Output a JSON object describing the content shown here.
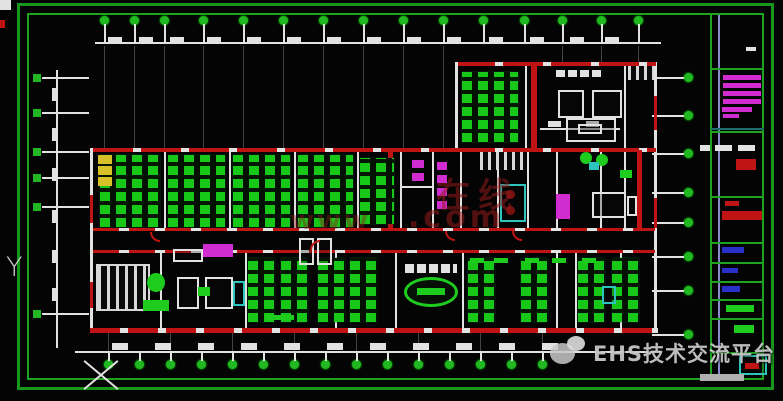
{
  "colors": {
    "background": "#040404",
    "frame_green": "#1ea31e",
    "wall_white": "#e2e2e2",
    "wall_red": "#c01414",
    "furniture_green": "#1ecc1e",
    "axis_bubble_green": "#22b822",
    "fixture_magenta": "#d02cd0",
    "fixture_cyan": "#2cc4bc",
    "fixture_yellow": "#d8c028",
    "titleblock_blue_line": "#8a8ad0",
    "titleblock_text_blue": "#2830c8",
    "watermark_red": "#961c1c",
    "watermark_gray": "#d6d6d6"
  },
  "watermarks": {
    "center_fragments": [
      {
        "text": "在线"
      },
      {
        "text": ".com"
      },
      {
        "text": "www"
      }
    ],
    "bottom_right": {
      "icon": "wechat-icon",
      "text": "EHS技术交流平台"
    }
  },
  "ucs": {
    "y_label": "Y"
  },
  "titleblock": {
    "rows": [
      {
        "name": "logo-mark",
        "style": "white-dash"
      },
      {
        "name": "project-title-block",
        "style": "magenta-text-lines"
      },
      {
        "name": "drawing-code-row",
        "style": "white-text-red-stamp"
      },
      {
        "name": "red-title-bar",
        "style": "red-bar"
      },
      {
        "name": "field-row-1",
        "style": "blue-text"
      },
      {
        "name": "field-row-2",
        "style": "blue-text"
      },
      {
        "name": "field-row-3",
        "style": "blue-text"
      },
      {
        "name": "scale-row",
        "style": "green-text"
      },
      {
        "name": "symbol-row",
        "style": "green-symbol"
      },
      {
        "name": "stamp-box",
        "style": "teal-box-red-text"
      }
    ]
  },
  "plan": {
    "elements": [
      "axis-grid-bubbles",
      "dimension-lines",
      "red-walls",
      "white-partitions",
      "green-workstation-clusters",
      "meeting-tables",
      "conference-oval-table",
      "stairs",
      "elevator-shafts",
      "toilet-fixtures",
      "sofa-set",
      "plants",
      "reception-desks",
      "radiator-comb",
      "pantry-fixtures"
    ]
  }
}
